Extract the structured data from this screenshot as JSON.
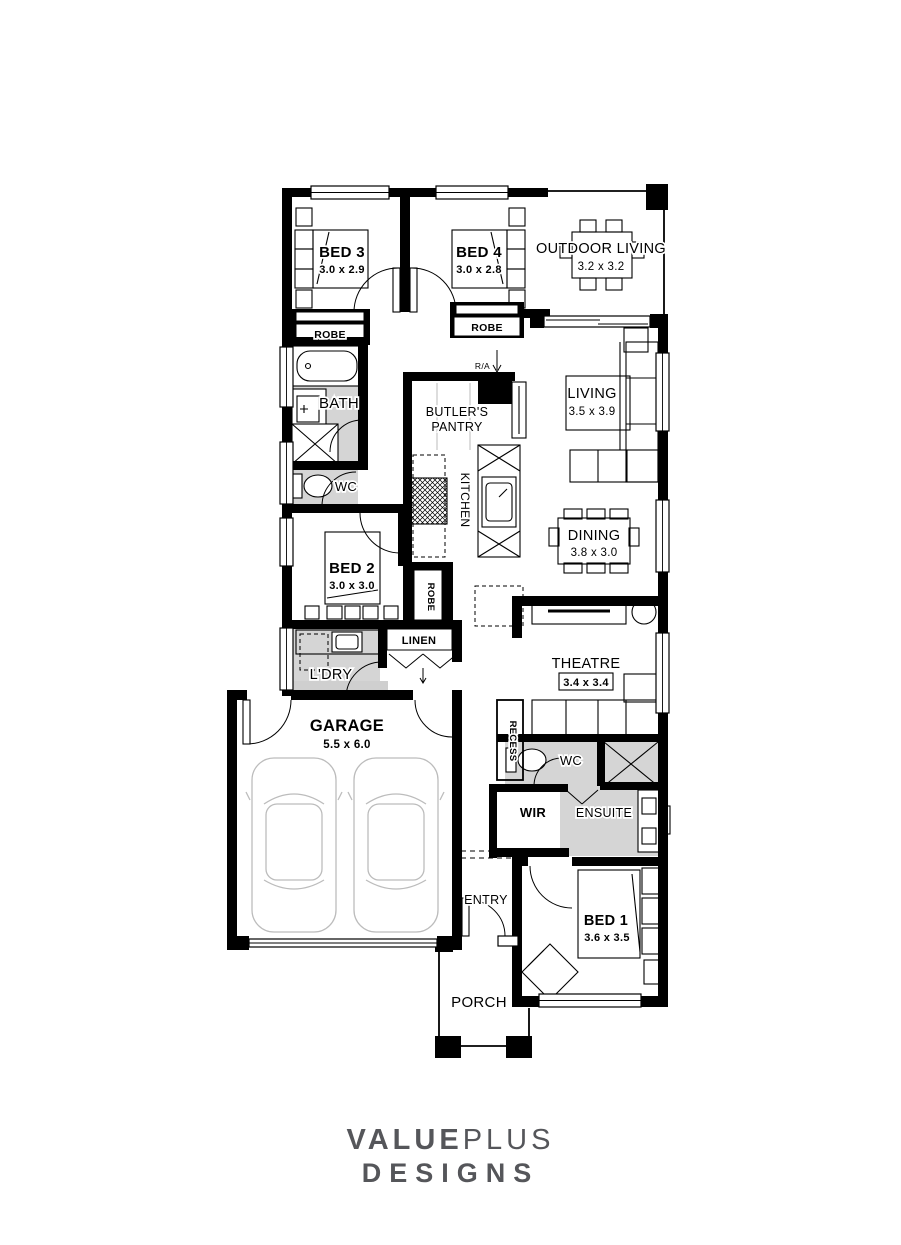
{
  "plan": {
    "wall_color": "#000000",
    "wet_floor_color": "#d5d5d5",
    "rooms": {
      "bed3": {
        "name": "BED 3",
        "dim": "3.0 x 2.9"
      },
      "bed4": {
        "name": "BED 4",
        "dim": "3.0 x 2.8"
      },
      "outdoor_living": {
        "name": "OUTDOOR LIVING",
        "dim": "3.2 x 3.2"
      },
      "robe_bed3": {
        "name": "ROBE"
      },
      "robe_bed4": {
        "name": "ROBE"
      },
      "bath": {
        "name": "BATH"
      },
      "wc": {
        "name": "WC"
      },
      "butlers_pantry": {
        "name_line1": "BUTLER'S",
        "name_line2": "PANTRY"
      },
      "kitchen": {
        "name": "KITCHEN"
      },
      "living": {
        "name": "LIVING",
        "dim": "3.5 x 3.9"
      },
      "dining": {
        "name": "DINING",
        "dim": "3.8 x 3.0"
      },
      "bed2": {
        "name": "BED 2",
        "dim": "3.0 x 3.0"
      },
      "robe_bed2": {
        "name": "ROBE"
      },
      "linen": {
        "name": "LINEN"
      },
      "laundry": {
        "name": "L'DRY"
      },
      "theatre": {
        "name": "THEATRE",
        "dim": "3.4 x 3.4"
      },
      "garage": {
        "name": "GARAGE",
        "dim": "5.5 x 6.0"
      },
      "recess": {
        "name": "RECESS"
      },
      "wc2": {
        "name": "WC"
      },
      "wir": {
        "name": "WIR"
      },
      "ensuite": {
        "name": "ENSUITE"
      },
      "entry": {
        "name": "ENTRY"
      },
      "bed1": {
        "name": "BED 1",
        "dim": "3.6 x 3.5"
      },
      "porch": {
        "name": "PORCH"
      }
    },
    "annotations": {
      "return_air": "R/A"
    }
  },
  "brand": {
    "name_part1": "VALUE",
    "name_part2": "PLUS",
    "name_line2": "DESIGNS",
    "color": "#55565a"
  }
}
